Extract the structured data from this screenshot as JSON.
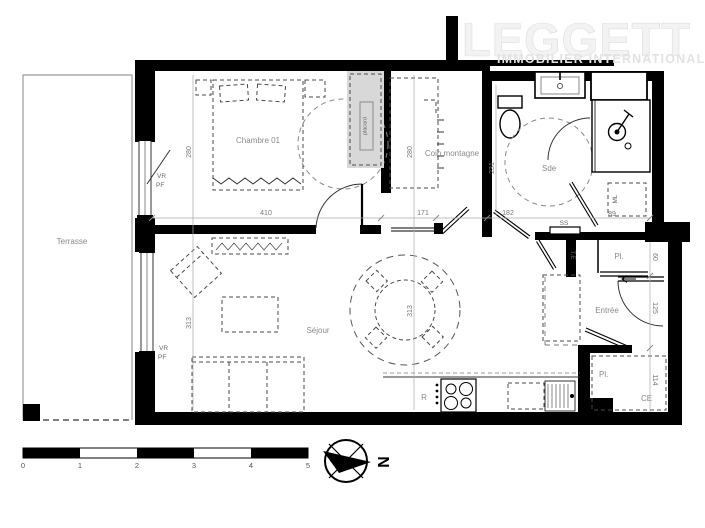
{
  "logo": {
    "brand": "LEGGETT",
    "tagline": "IMMOBILIER  INTERNATIONAL"
  },
  "rooms": {
    "terrasse": "Terrasse",
    "chambre": "Chambre 01",
    "coin_montagne": "Coin montagne",
    "sde": "Sde",
    "sejour": "Séjour",
    "entree": "Entrée"
  },
  "labels": {
    "placard_top": "Pl.",
    "placard_bottom": "Pl.",
    "water_heater": "CE",
    "washing_machine": "ML",
    "fridge": "R",
    "towel_rail": "SS",
    "electrical_panel": "T.E",
    "closet_strip": "placard",
    "chambre_window_vr": "VR",
    "chambre_window_pf": "PF",
    "sejour_window_vr": "VR",
    "sejour_window_pf": "PF"
  },
  "dimensions": {
    "chambre_width": "410",
    "chambre_height": "280",
    "coin_width": "171",
    "coin_height": "280",
    "sde_width": "182",
    "sde_height": "231",
    "sejour_height_left": "313",
    "sejour_height_mid": "313",
    "ml_width": "89",
    "placard_top_height": "60",
    "entree_height": "125",
    "placard_bottom_height": "114"
  },
  "scale_bar": {
    "ticks": [
      "0",
      "1",
      "2",
      "3",
      "4",
      "5"
    ]
  },
  "compass": {
    "north": "N"
  },
  "colors": {
    "wall": "#000000",
    "label_gray": "#8a8a8a",
    "logo_gray": "#e8e8e8"
  }
}
